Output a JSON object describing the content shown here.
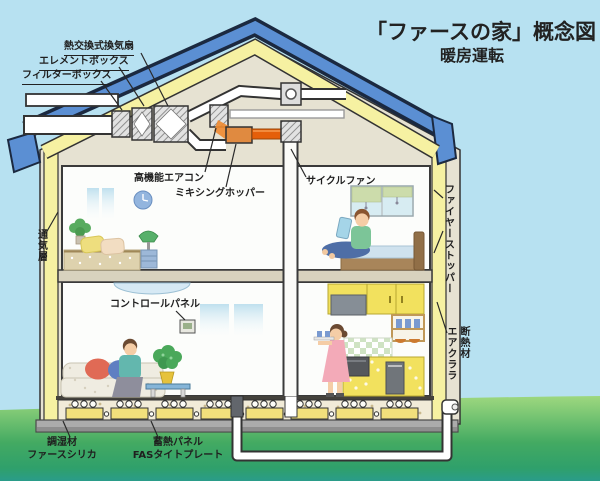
{
  "title": {
    "main": "「ファースの家」概念図",
    "subtitle": "暖房運転"
  },
  "labels": {
    "heat_exchange_fan": "熱交換式換気扇",
    "element_box": "エレメントボックス",
    "filter_box": "フィルターボックス",
    "high_function_aircon": "高機能エアコン",
    "mixing_hopper": "ミキシングホッパー",
    "cycle_fan": "サイクルファン",
    "ventilation_layer": "通気層",
    "fire_stopper": "ファイヤーストッパー",
    "control_panel": "コントロールパネル",
    "insulation_material": "断熱材\nエアクララ",
    "humidity_control_material": "調湿材\nファースシリカ",
    "heat_storage_panel": "蓄熱パネル\nFASタイトプレート"
  },
  "colors": {
    "sky": "#b7e1f1",
    "ground_green_top": "#9ed87f",
    "ground_green_bottom": "#2a9c8a",
    "roof_blue": "#5b8fd3",
    "outline_navy": "#1b2940",
    "insulation_yellow": "#f6f1a2",
    "attic_cream": "#e6e2d2",
    "room_white": "#fcfdfb",
    "floor_beige": "#d8d2be",
    "warm_air_orange": "#e55f0a",
    "kitchen_yellow": "#f2e15e",
    "concrete_gray": "#ababab"
  }
}
